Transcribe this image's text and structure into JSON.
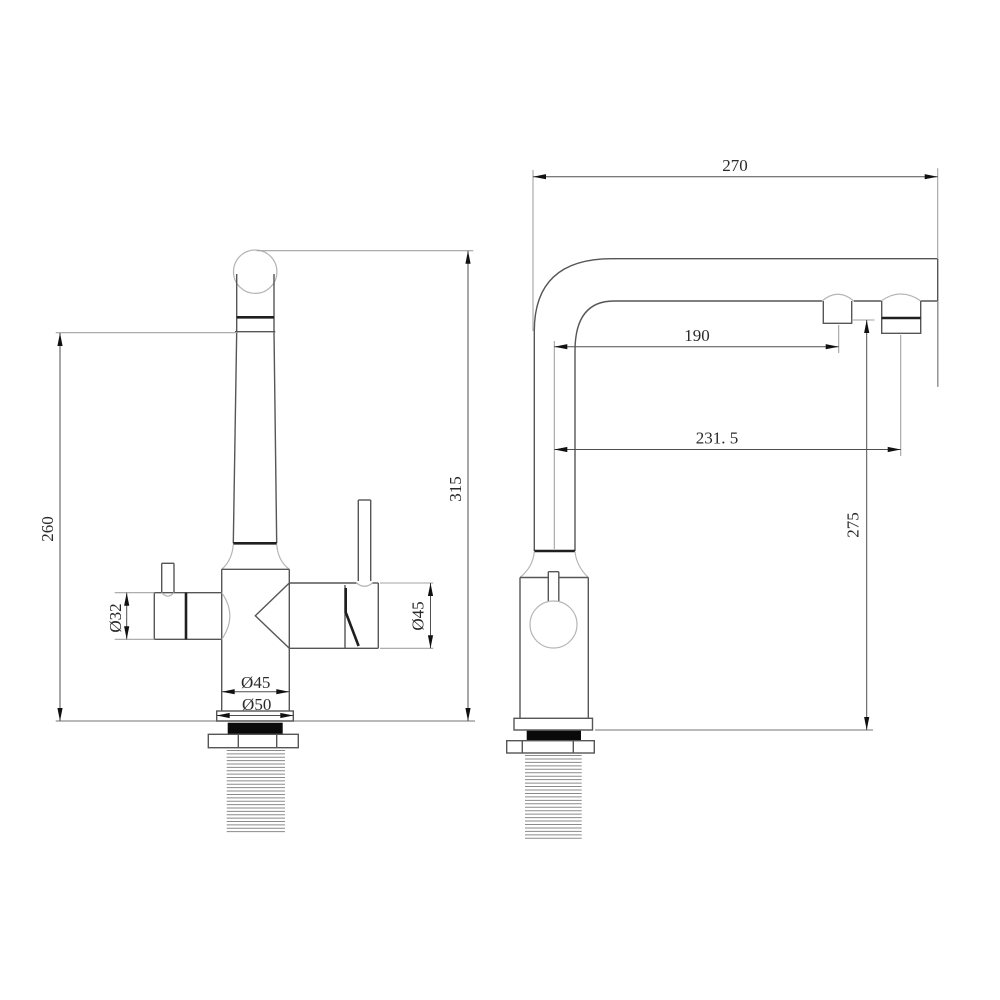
{
  "drawing": {
    "title": "kitchen-faucet-installation-dimensions",
    "front_view": {
      "height_to_spout": "260",
      "overall_height": "315",
      "left_handle_dia": "Ø32",
      "right_handle_dia": "Ø45",
      "body_dia": "Ø45",
      "base_dia": "Ø50"
    },
    "side_view": {
      "reach_overall": "270",
      "reach_outlet_1": "190",
      "reach_outlet_2": "231. 5",
      "spout_height": "275"
    },
    "colors": {
      "background": "#ffffff",
      "object_line": "#565656",
      "accent_dark_line": "#1f1f1f",
      "light_line": "#b5b5b5",
      "dimension_line": "#4f4f4f",
      "extension_line": "#a3a3a3",
      "gasket_fill": "#0a0a0a"
    }
  }
}
